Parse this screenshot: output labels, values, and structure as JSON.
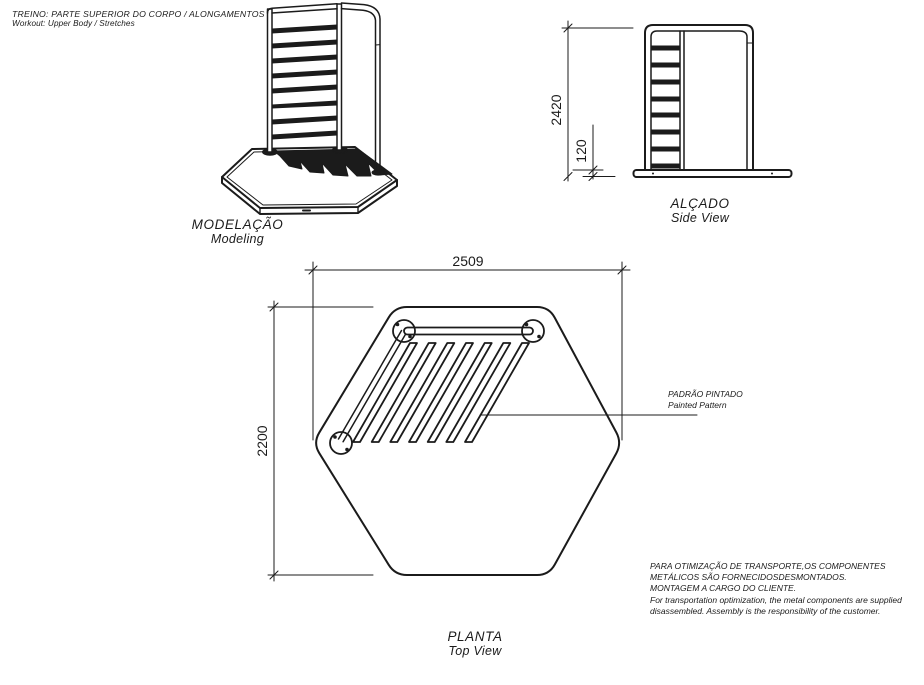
{
  "header": {
    "line1": "TREINO: PARTE SUPERIOR DO CORPO / ALONGAMENTOS",
    "line2": "Workout: Upper Body / Stretches"
  },
  "modeling_view": {
    "label_pt": "MODELAÇÃO",
    "label_en": "Modeling"
  },
  "side_view": {
    "label_pt": "ALÇADO",
    "label_en": "Side View",
    "dim_total_height": "2420",
    "dim_base_thickness": "120"
  },
  "plan_view": {
    "label_pt": "PLANTA",
    "label_en": "Top View",
    "dim_width": "2509",
    "dim_depth": "2200",
    "callout_pt": "PADRÃO PINTADO",
    "callout_en": "Painted Pattern"
  },
  "notes": {
    "pt1": "PARA OTIMIZAÇÃO DE TRANSPORTE,OS COMPONENTES",
    "pt2": "METÁLICOS SÃO FORNECIDOSDESMONTADOS.",
    "pt3": "MONTAGEM A CARGO DO CLIENTE.",
    "en1": "For transportation optimization, the metal components are supplied",
    "en2": "disassembled. Assembly is the responsibility of the customer."
  },
  "colors": {
    "line": "#1b1b1b",
    "background": "#ffffff"
  }
}
